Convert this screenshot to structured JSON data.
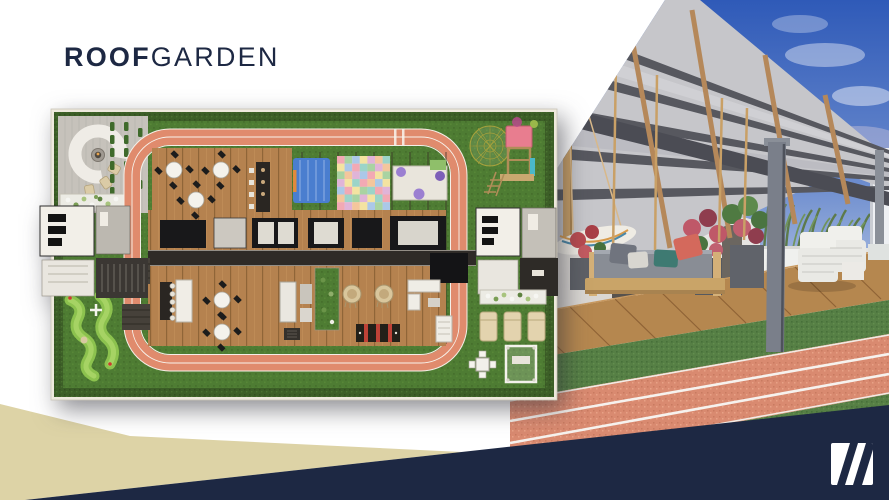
{
  "slide": {
    "title": {
      "bold": "ROOF",
      "light": "GARDEN"
    }
  },
  "palette": {
    "navy": "#1d2843",
    "beige": "#ddd3a6",
    "track": "#e08b6d",
    "grass": "#4e7c33",
    "hedge": "#3c5e27",
    "deck": "#b5824f",
    "paper": "#ffffff"
  },
  "floor_plan": {
    "name": "roof-garden-floor-plan",
    "amenities": [
      "lounge-terrace-curved-sofa",
      "vertical-planters",
      "flower-beds",
      "running-track-loop",
      "dining-deck-tables",
      "bar-counter",
      "kids-play-mat",
      "kids-canopy-bed",
      "kids-play-bench",
      "geodesic-dome",
      "climbing-tower",
      "mini-golf",
      "outdoor-kitchen",
      "cocoon-swings",
      "game-table",
      "lounge-sofas",
      "sun-loungers",
      "garden-dining-pergola",
      "service-cores"
    ]
  },
  "photo": {
    "name": "roof-garden-3d-render",
    "elements": [
      "sky",
      "steel-pergola",
      "wood-rafters",
      "wall-tv",
      "hanging-daybed-swing",
      "hammock",
      "flower-planters",
      "white-lounge-chairs",
      "wood-deck",
      "lawn-strips",
      "running-track-lanes"
    ]
  },
  "logo": {
    "name": "brand-logo-mark",
    "stripe_count": 2
  }
}
